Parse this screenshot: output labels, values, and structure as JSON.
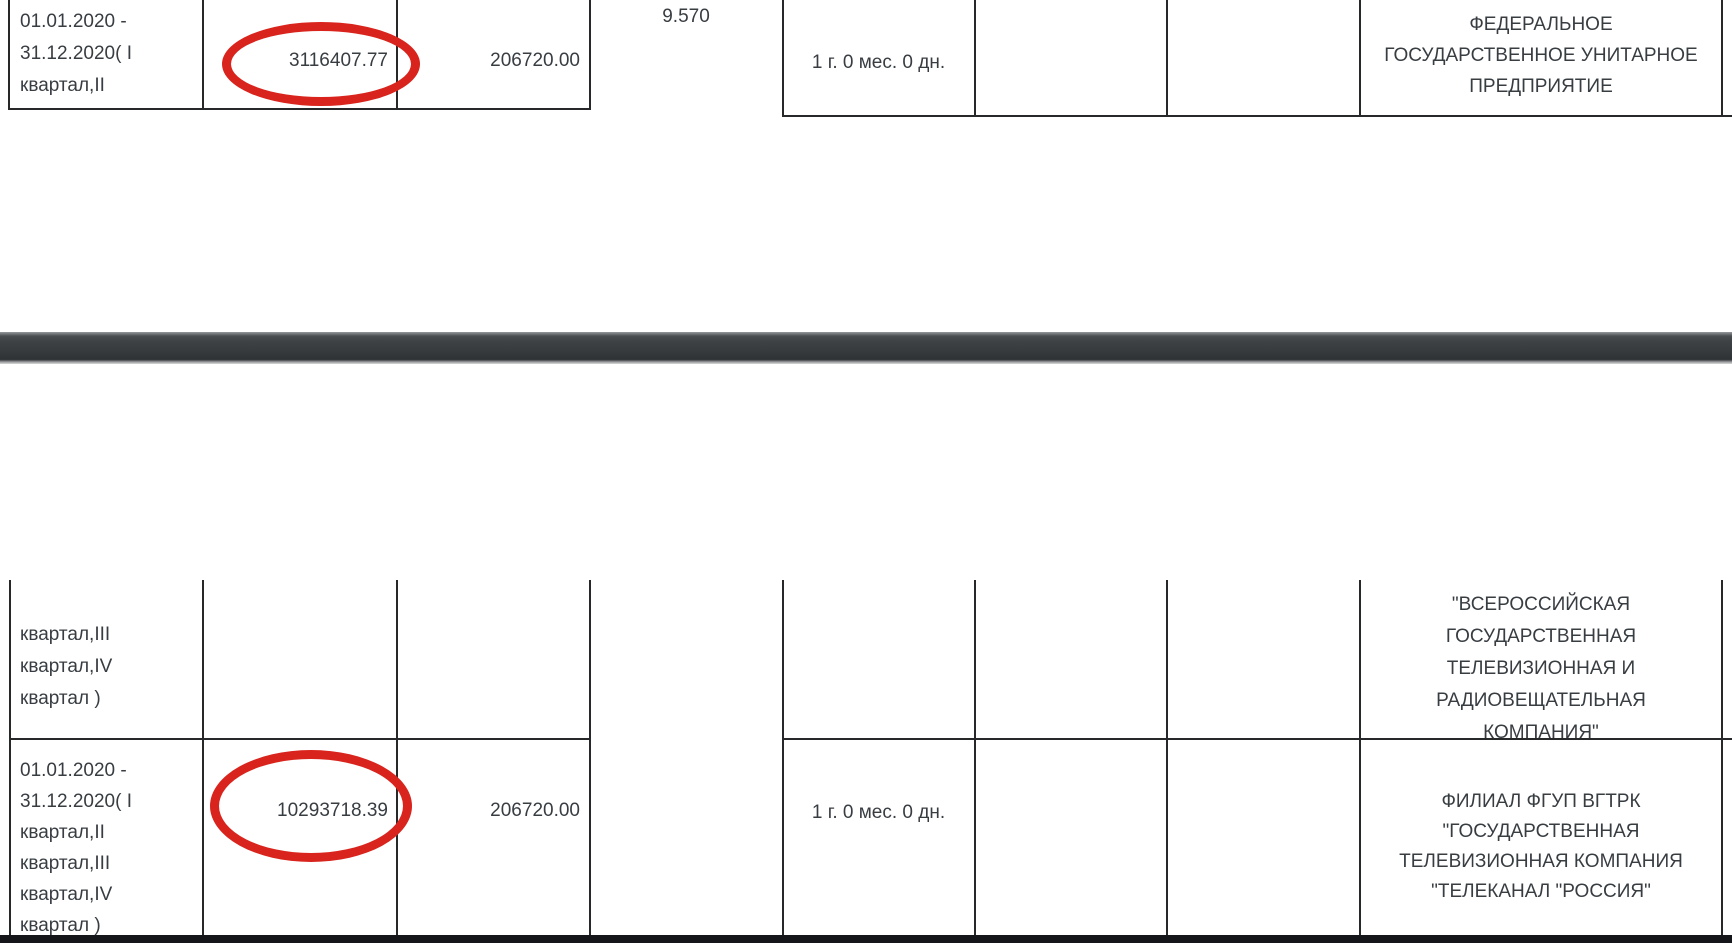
{
  "annotation": {
    "circle_color": "#d8241c",
    "note": "hand-drawn red ellipse highlights"
  },
  "top_row": {
    "period_lines": [
      "01.01.2020 -",
      "31.12.2020( I",
      "квартал,II"
    ],
    "paid_amount": "3116407.77",
    "contract_price": "206720.00",
    "rate": "9.570",
    "duration": "1 г. 0 мес. 0 дн.",
    "supplier_lines": [
      "ФЕДЕРАЛЬНОЕ",
      "ГОСУДАРСТВЕННОЕ УНИТАРНОЕ",
      "ПРЕДПРИЯТИЕ"
    ]
  },
  "bottom_row_continued": {
    "period_lines": [
      "квартал,III",
      "квартал,IV",
      "квартал )"
    ],
    "supplier_lines": [
      "\"ВСЕРОССИЙСКАЯ",
      "ГОСУДАРСТВЕННАЯ",
      "ТЕЛЕВИЗИОННАЯ И",
      "РАДИОВЕЩАТЕЛЬНАЯ",
      "КОМПАНИЯ\""
    ]
  },
  "bottom_row": {
    "period_lines": [
      "01.01.2020 -",
      "31.12.2020( I",
      "квартал,II",
      "квартал,III",
      "квартал,IV",
      "квартал )"
    ],
    "paid_amount": "10293718.39",
    "contract_price": "206720.00",
    "duration": "1 г. 0 мес. 0 дн.",
    "supplier_lines": [
      "ФИЛИАЛ ФГУП ВГТРК",
      "\"ГОСУДАРСТВЕННАЯ",
      "ТЕЛЕВИЗИОННАЯ КОМПАНИЯ",
      "\"ТЕЛЕКАНАЛ \"РОССИЯ\""
    ]
  }
}
